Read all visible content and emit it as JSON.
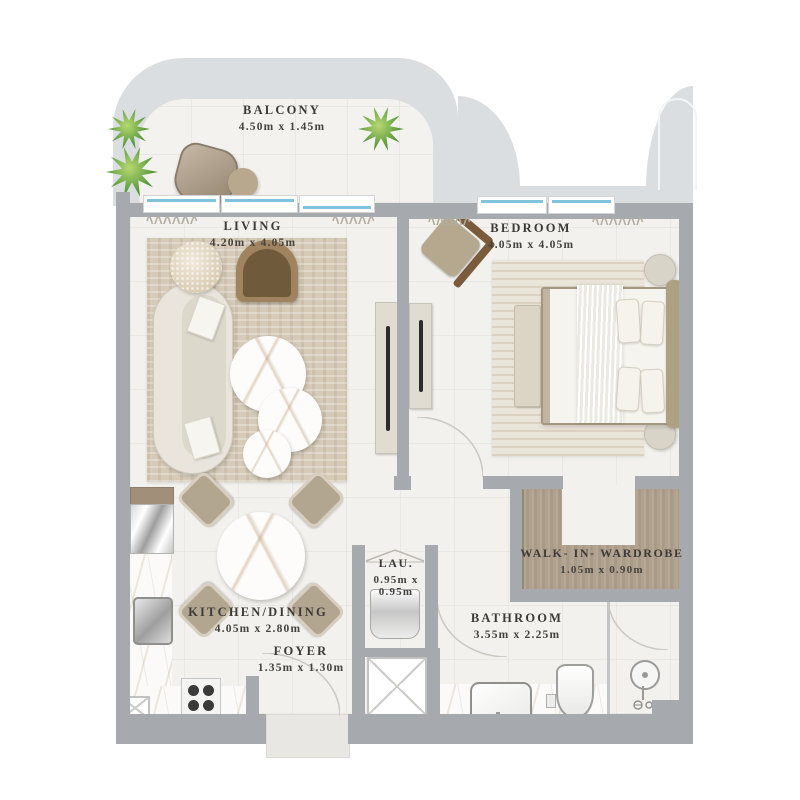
{
  "rooms": {
    "balcony": {
      "label": "BALCONY",
      "dims": "4.50m x 1.45m"
    },
    "living": {
      "label": "LIVING",
      "dims": "4.20m x 4.05m"
    },
    "bedroom": {
      "label": "BEDROOM",
      "dims": "4.05m x 4.05m"
    },
    "wardrobe": {
      "label": "WALK- IN- WARDROBE",
      "dims": "1.05m x 0.90m"
    },
    "bathroom": {
      "label": "BATHROOM",
      "dims": "3.55m x 2.25m"
    },
    "kitchen": {
      "label": "KITCHEN/DINING",
      "dims": "4.05m x 2.80m"
    },
    "laundry": {
      "label": "LAU.",
      "dims_line1": "0.95m x",
      "dims_line2": "0.95m"
    },
    "foyer": {
      "label": "FOYER",
      "dims": "1.35m x 1.30m"
    }
  },
  "colors": {
    "wall": "#a6aaae",
    "exterior_band": "#dbdee1",
    "floor": "#f2f1ed",
    "window_glass": "#7fc4dc",
    "wardrobe_wood": "#ab9c8b",
    "living_rug": "#d6cbb8",
    "plant_green": "#5d9c3e"
  }
}
